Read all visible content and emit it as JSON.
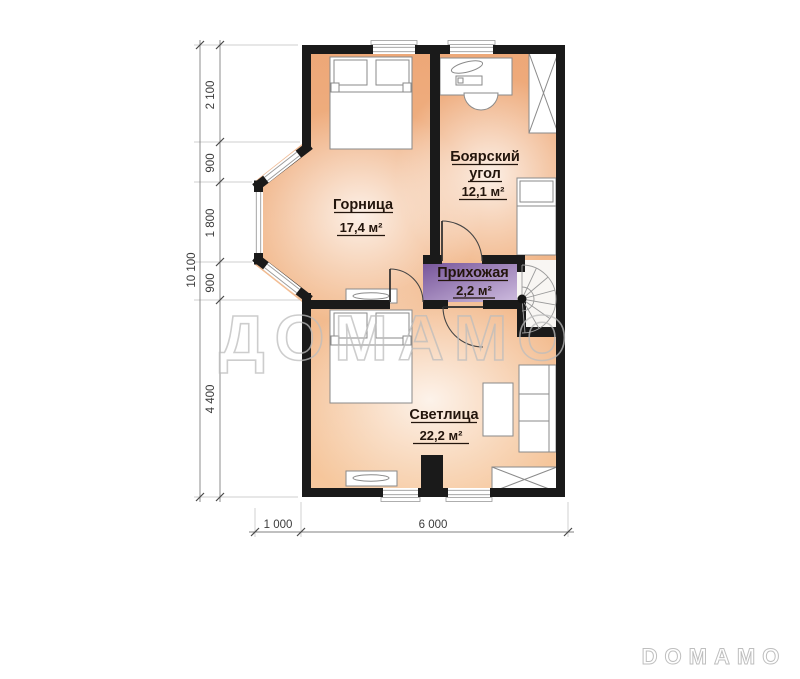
{
  "watermark": {
    "large": "ДОМАМО",
    "small": "DOMAMO"
  },
  "rooms": {
    "gornitsa": {
      "name": "Горница",
      "area": "17,4 м²"
    },
    "boyarsky": {
      "name_line1": "Боярский",
      "name_line2": "угол",
      "area": "12,1 м²"
    },
    "prihozhaya": {
      "name": "Прихожая",
      "area": "2,2 м²"
    },
    "svetlitsa": {
      "name": "Светлица",
      "area": "22,2 м²"
    }
  },
  "dimensions": {
    "left_total": "10 100",
    "left_segments": [
      "2 100",
      "900",
      "1 800",
      "900",
      "4 400"
    ],
    "bottom_segments": [
      "1 000",
      "6 000"
    ]
  },
  "colors": {
    "wall": "#1a1a1a",
    "floor_warm": "#f0b285",
    "hall_purple": "#8a67a8",
    "watermark": "#bdbdbd"
  }
}
